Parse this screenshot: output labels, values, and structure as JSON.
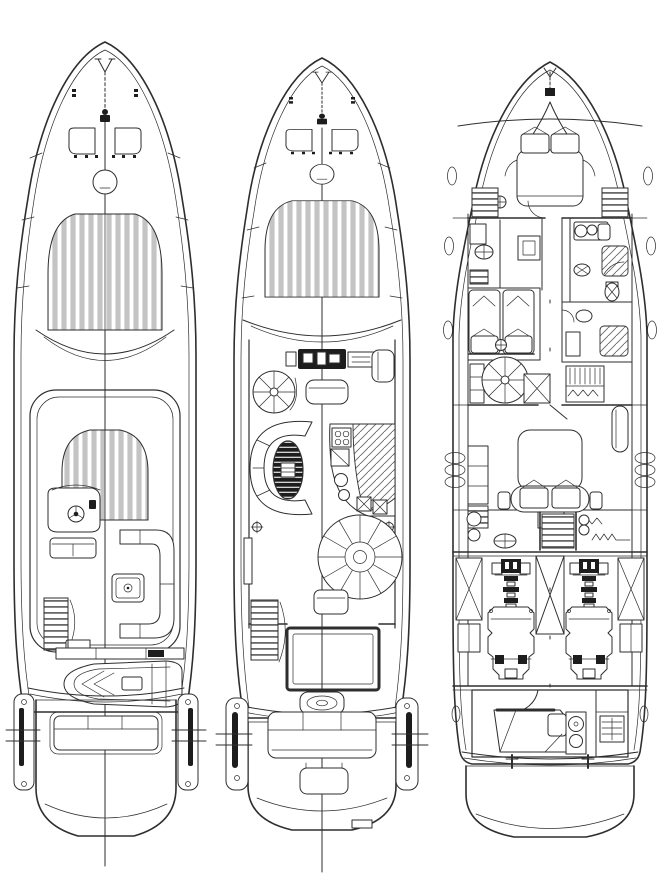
{
  "figure": {
    "subject": "motor-yacht-deck-plans",
    "type": "technical-line-drawing",
    "colors": {
      "paper": "#ffffff",
      "ink": "#2e2e2e",
      "ink-soft": "#6a6a6a",
      "slat": "#c4c4c4",
      "dark": "#1d1d1d",
      "table-line": "#e8e8e8"
    },
    "panels": [
      {
        "name": "flybridge-deck-plan",
        "position": "left",
        "features": [
          "bow-anchor-windlass",
          "anchor-chain",
          "bow-cleats",
          "foredeck-hatches",
          "round-deck-hatch",
          "foredeck-sunpad",
          "windshield",
          "hardtop-coaming",
          "flybridge-sunpad",
          "helm-console-with-wheel",
          "helm-bench-seat",
          "l-shaped-sofa",
          "cocktail-table",
          "flybridge-stairs",
          "passerelle-beam",
          "tender-on-aft-deck",
          "aft-bench",
          "stern-wings",
          "swim-platform",
          "centerline-with-station-marks"
        ]
      },
      {
        "name": "main-deck-plan",
        "position": "middle",
        "features": [
          "bow-anchor-windlass",
          "anchor-chain",
          "bow-cleats",
          "foredeck-hatches",
          "round-deck-hatch",
          "foredeck-sunpad",
          "windshield",
          "helm-station-displays",
          "helm-seat",
          "side-door",
          "spiral-staircase",
          "curved-saloon-sofa",
          "oval-cocktail-table",
          "galley-counter",
          "stove",
          "sinks",
          "refrigerator",
          "round-dining-table",
          "dining-bench",
          "pedestal-marks",
          "cockpit-stairs",
          "cockpit-sunpad",
          "engine-hatch",
          "aft-bench",
          "stern-wings",
          "swim-platform",
          "platform-hatch",
          "centerline-with-station-marks"
        ]
      },
      {
        "name": "lower-deck-plan",
        "position": "right",
        "features": [
          "bow-windlass",
          "vip-cabin-double-bed",
          "pillows",
          "hanging-lockers",
          "portholes",
          "day-head-sink",
          "lobby-cabinet",
          "guest-bathroom-sinks",
          "shower",
          "toilet",
          "bidet",
          "twin-guest-cabin",
          "twin-beds",
          "spiral-staircase",
          "closet",
          "wardrobe",
          "mid-bathroom",
          "master-cabin-double-bed",
          "master-sofa",
          "dresser",
          "hull-windows",
          "washbasin",
          "companionway-steps",
          "engine-room",
          "port-engine",
          "starboard-engine",
          "fuel-tanks",
          "cross-bracing",
          "crew-cabin",
          "crew-berth",
          "crew-sink",
          "crew-ladder",
          "mooring-bollards",
          "transom",
          "swim-platform"
        ]
      }
    ]
  }
}
